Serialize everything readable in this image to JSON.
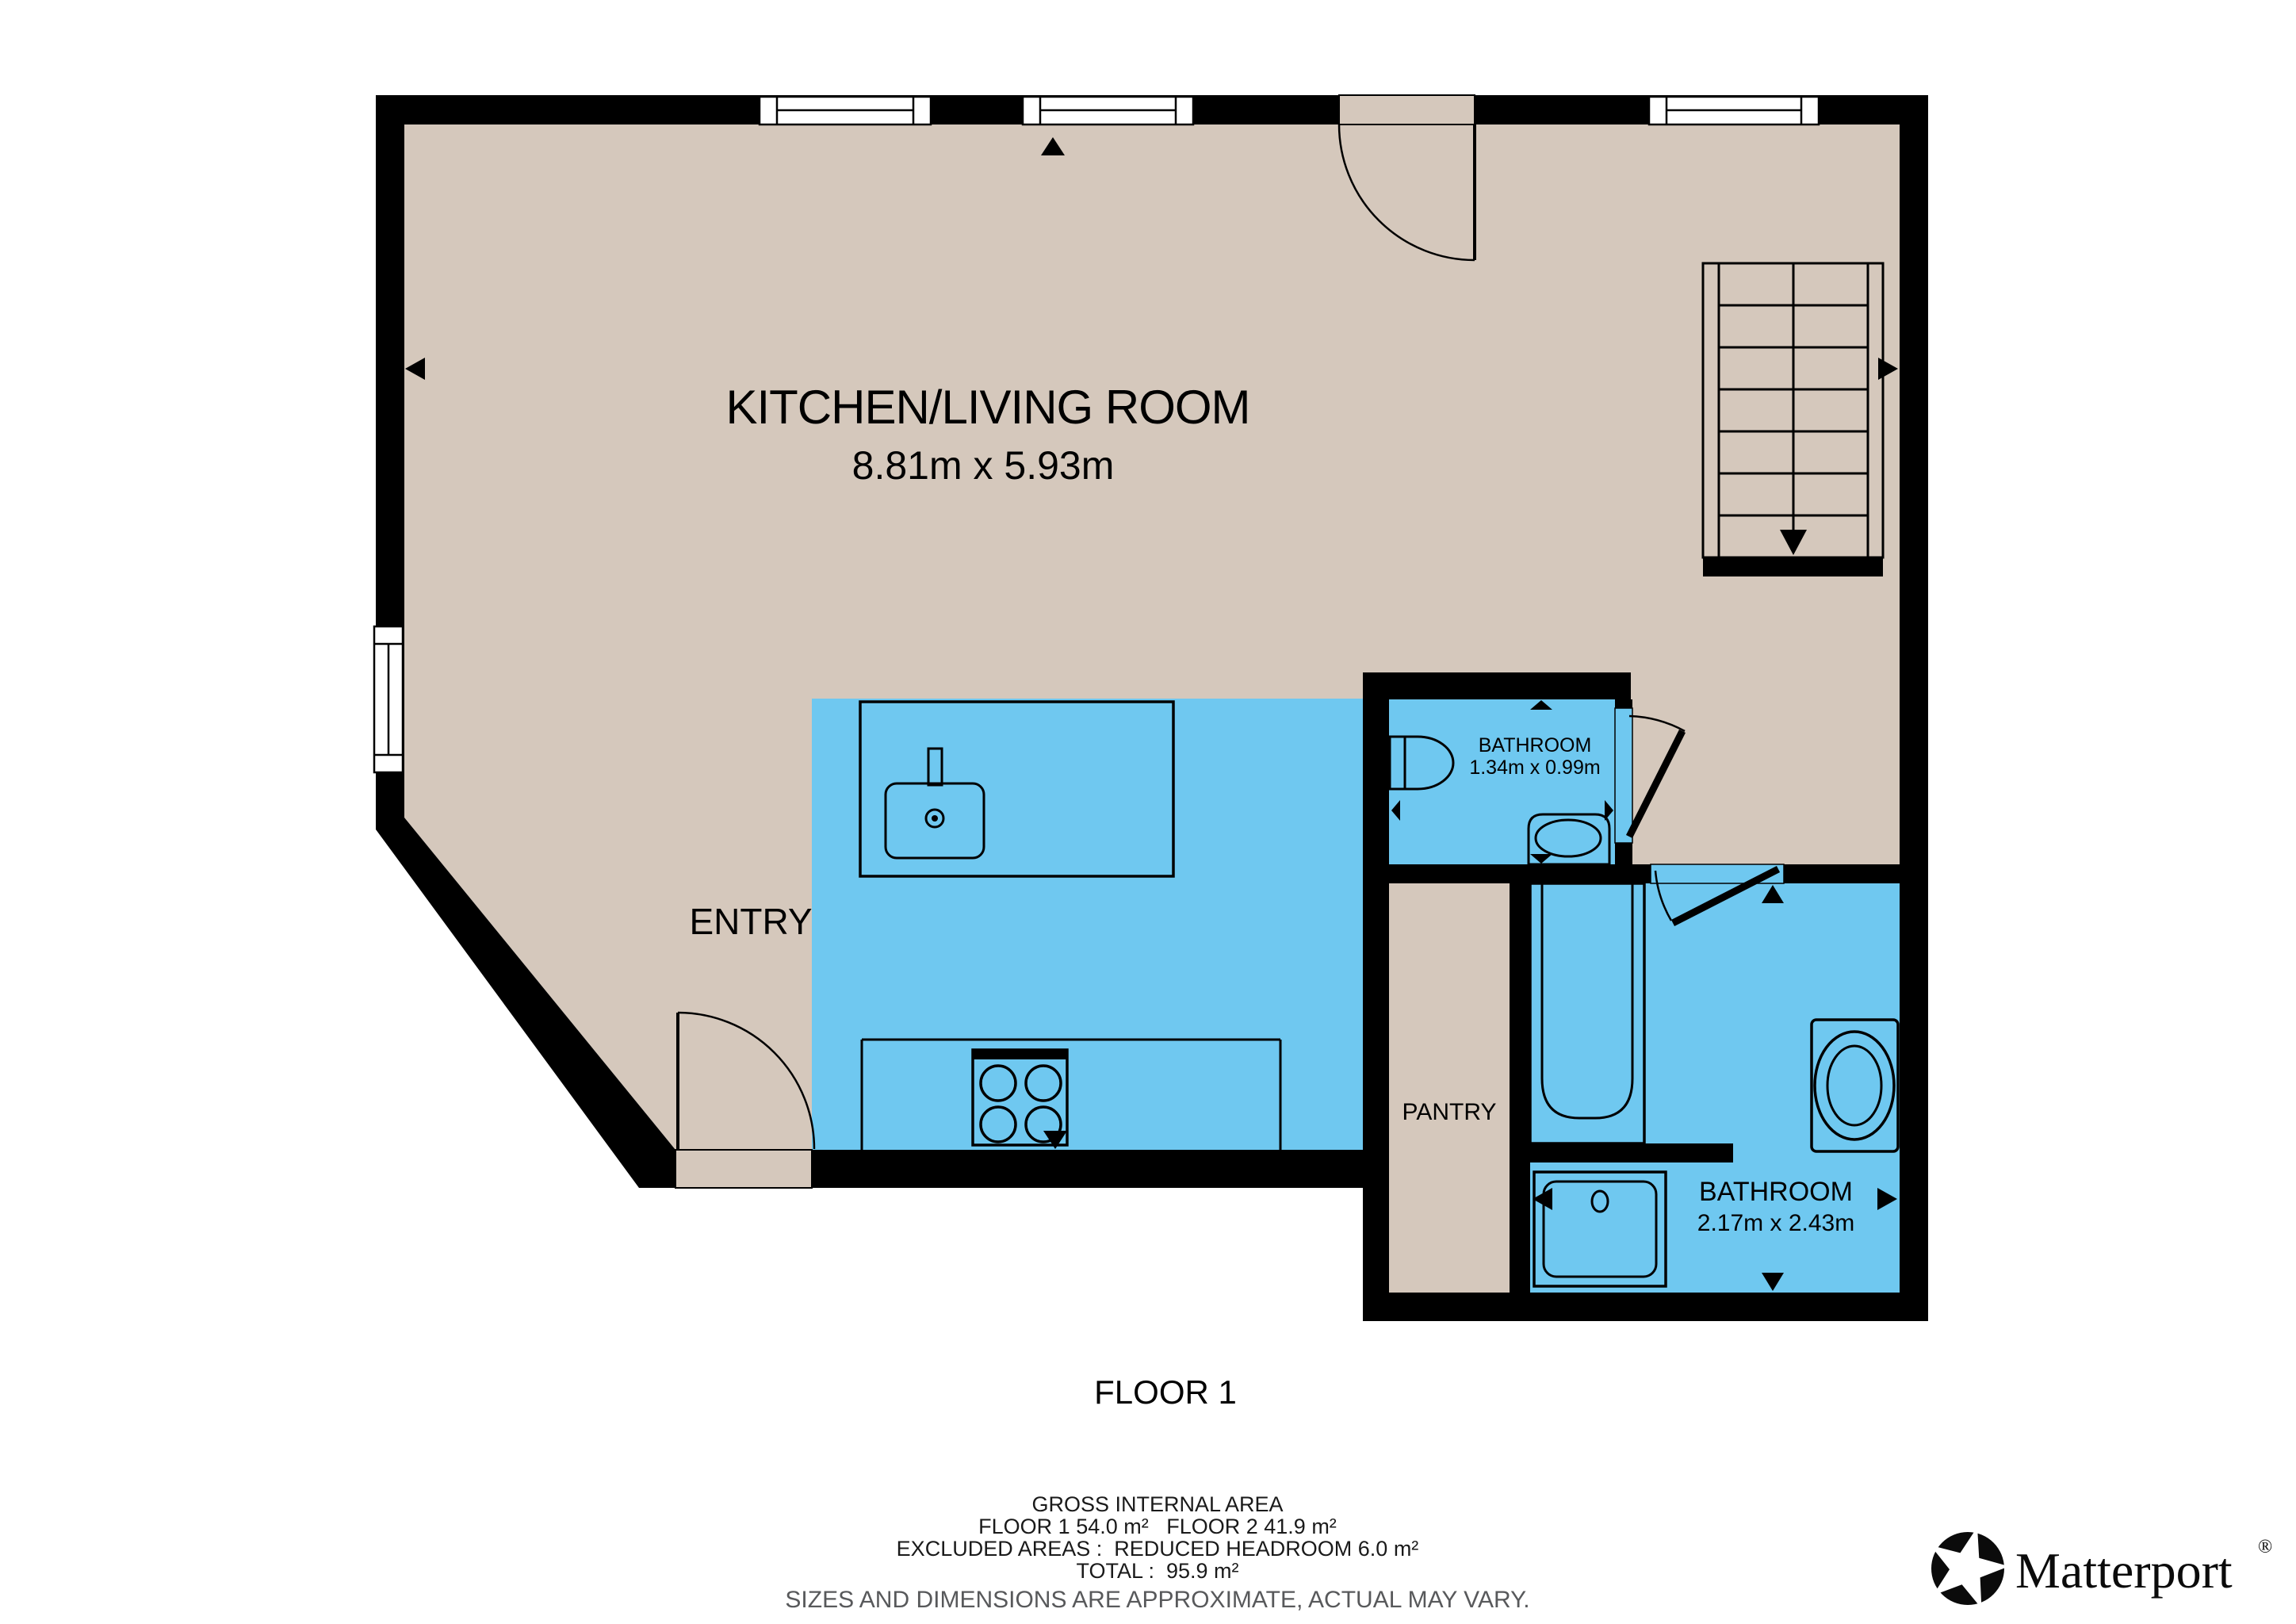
{
  "plan": {
    "floor_label": "FLOOR 1",
    "rooms": {
      "kitchen_living": {
        "name": "KITCHEN/LIVING ROOM",
        "dims": "8.81m x 5.93m"
      },
      "entry": {
        "name": "ENTRY"
      },
      "bathroom_small": {
        "name": "BATHROOM",
        "dims": "1.34m x 0.99m"
      },
      "pantry": {
        "name": "PANTRY"
      },
      "bathroom_large": {
        "name": "BATHROOM",
        "dims": "2.17m x 2.43m"
      }
    },
    "colors": {
      "floor_tan": "#D5C8BC",
      "zone_blue": "#6FC8F0",
      "wall_black": "#000000"
    }
  },
  "footer": {
    "title": "GROSS INTERNAL AREA",
    "areas": "FLOOR 1 54.0 m²   FLOOR 2 41.9 m²",
    "excluded": "EXCLUDED AREAS :  REDUCED HEADROOM 6.0 m²",
    "total": "TOTAL :  95.9 m²",
    "disclaimer": "SIZES AND DIMENSIONS ARE APPROXIMATE, ACTUAL MAY VARY."
  },
  "branding": {
    "name": "Matterport",
    "mark": "®"
  }
}
